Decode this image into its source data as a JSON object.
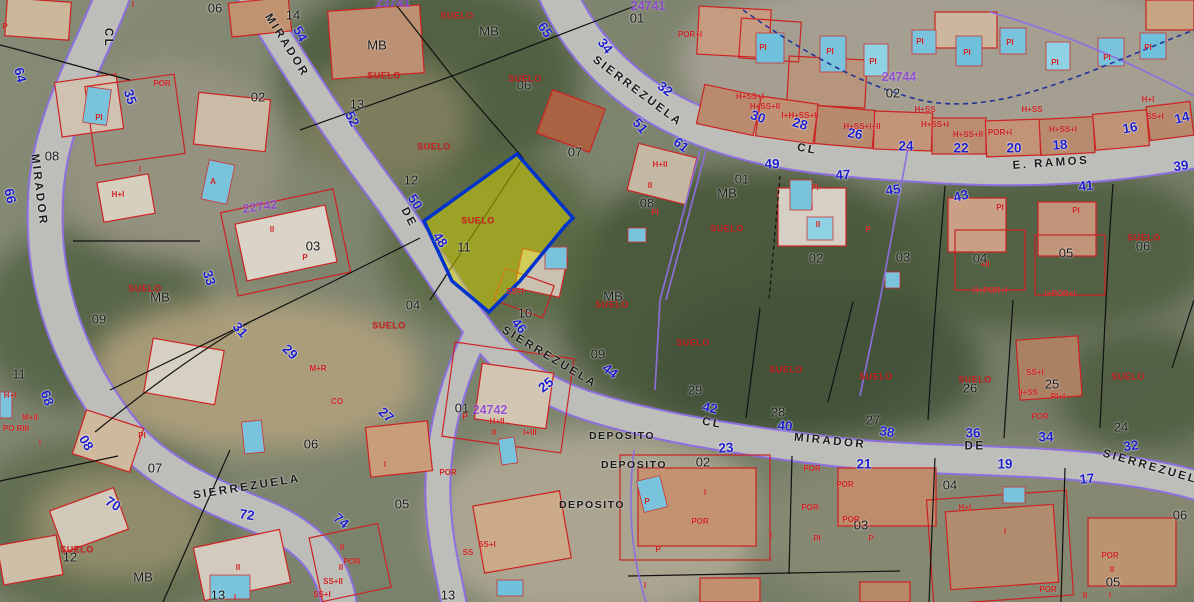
{
  "map": {
    "type": "cadastral-aerial",
    "selected_parcel": {
      "label": "SUELO",
      "fill": "#d8d800",
      "border": "#0033cc"
    },
    "colors": {
      "street_name": "#1a1a1a",
      "parcel_number": "#141414",
      "street_number": "#1c1cc8",
      "building_outline": "#cc2222",
      "suelo": "#cc2222",
      "parcel_id": "#8d3fd8",
      "urban_boundary": "#8d6fe0",
      "boundary_dashed": "#223399",
      "road_fill": "#bdbdba",
      "pool": "#79c4dc",
      "highlight_fill": "#d8d800",
      "highlight_border": "#0033cc"
    },
    "street_labels": [
      {
        "t": "CL",
        "x": 107,
        "y": 38,
        "r": 90
      },
      {
        "t": "MIRADOR",
        "x": 286,
        "y": 46,
        "r": 58
      },
      {
        "t": "MIRADOR",
        "x": 38,
        "y": 190,
        "r": 83
      },
      {
        "t": "SIERREZUELA",
        "x": 637,
        "y": 92,
        "r": 37
      },
      {
        "t": "CL",
        "x": 807,
        "y": 150,
        "r": 10
      },
      {
        "t": "E. RAMOS",
        "x": 1051,
        "y": 164,
        "r": -4
      },
      {
        "t": "DE",
        "x": 408,
        "y": 218,
        "r": 62
      },
      {
        "t": "SIERREZUELA",
        "x": 549,
        "y": 358,
        "r": 31
      },
      {
        "t": "CL",
        "x": 712,
        "y": 424,
        "r": 10
      },
      {
        "t": "MIRADOR",
        "x": 830,
        "y": 442,
        "r": 6
      },
      {
        "t": "DE",
        "x": 975,
        "y": 447,
        "r": 0
      },
      {
        "t": "SIERREZUELA",
        "x": 1155,
        "y": 469,
        "r": 16
      },
      {
        "t": "SIERREZUELA",
        "x": 247,
        "y": 488,
        "r": -9
      }
    ],
    "deposito_labels": [
      {
        "t": "DEPOSITO",
        "x": 622,
        "y": 436
      },
      {
        "t": "DEPOSITO",
        "x": 634,
        "y": 465
      },
      {
        "t": "DEPOSITO",
        "x": 592,
        "y": 505
      }
    ],
    "parcel_numbers": [
      {
        "t": "06",
        "x": 215,
        "y": 8
      },
      {
        "t": "14",
        "x": 293,
        "y": 15
      },
      {
        "t": "02",
        "x": 258,
        "y": 97
      },
      {
        "t": "08",
        "x": 52,
        "y": 156
      },
      {
        "t": "13",
        "x": 357,
        "y": 104
      },
      {
        "t": "MB",
        "x": 377,
        "y": 45
      },
      {
        "t": "MB",
        "x": 489,
        "y": 31
      },
      {
        "t": "12",
        "x": 411,
        "y": 180
      },
      {
        "t": "11",
        "x": 464,
        "y": 247
      },
      {
        "t": "06",
        "x": 524,
        "y": 85
      },
      {
        "t": "07",
        "x": 575,
        "y": 152
      },
      {
        "t": "01",
        "x": 637,
        "y": 18
      },
      {
        "t": "MB",
        "x": 160,
        "y": 297
      },
      {
        "t": "03",
        "x": 313,
        "y": 246
      },
      {
        "t": "09",
        "x": 99,
        "y": 319
      },
      {
        "t": "11",
        "x": 19,
        "y": 374
      },
      {
        "t": "01",
        "x": 742,
        "y": 179
      },
      {
        "t": "MB",
        "x": 727,
        "y": 193
      },
      {
        "t": "08",
        "x": 647,
        "y": 203
      },
      {
        "t": "02",
        "x": 816,
        "y": 258
      },
      {
        "t": "MB",
        "x": 613,
        "y": 296
      },
      {
        "t": "02",
        "x": 893,
        "y": 93
      },
      {
        "t": "03",
        "x": 903,
        "y": 257
      },
      {
        "t": "04",
        "x": 980,
        "y": 258
      },
      {
        "t": "05",
        "x": 1066,
        "y": 253
      },
      {
        "t": "06",
        "x": 1143,
        "y": 246
      },
      {
        "t": "09",
        "x": 598,
        "y": 354
      },
      {
        "t": "29",
        "x": 695,
        "y": 390
      },
      {
        "t": "28",
        "x": 778,
        "y": 412
      },
      {
        "t": "27",
        "x": 873,
        "y": 420
      },
      {
        "t": "26",
        "x": 970,
        "y": 388
      },
      {
        "t": "25",
        "x": 1052,
        "y": 384
      },
      {
        "t": "24",
        "x": 1121,
        "y": 427
      },
      {
        "t": "04",
        "x": 413,
        "y": 305
      },
      {
        "t": "10",
        "x": 525,
        "y": 313
      },
      {
        "t": "01",
        "x": 462,
        "y": 408
      },
      {
        "t": "06",
        "x": 311,
        "y": 444
      },
      {
        "t": "05",
        "x": 402,
        "y": 504
      },
      {
        "t": "13",
        "x": 448,
        "y": 595
      },
      {
        "t": "12",
        "x": 70,
        "y": 557
      },
      {
        "t": "MB",
        "x": 143,
        "y": 577
      },
      {
        "t": "13",
        "x": 218,
        "y": 595
      },
      {
        "t": "07",
        "x": 155,
        "y": 468
      },
      {
        "t": "02",
        "x": 703,
        "y": 462
      },
      {
        "t": "03",
        "x": 861,
        "y": 525
      },
      {
        "t": "04",
        "x": 950,
        "y": 485
      },
      {
        "t": "06",
        "x": 1180,
        "y": 515
      },
      {
        "t": "05",
        "x": 1113,
        "y": 582
      }
    ],
    "street_numbers": [
      {
        "t": "64",
        "x": 20,
        "y": 75,
        "r": 75
      },
      {
        "t": "66",
        "x": 10,
        "y": 196,
        "r": 78
      },
      {
        "t": "68",
        "x": 47,
        "y": 398,
        "r": 70
      },
      {
        "t": "70",
        "x": 113,
        "y": 504,
        "r": 32
      },
      {
        "t": "72",
        "x": 247,
        "y": 515,
        "r": 8
      },
      {
        "t": "74",
        "x": 341,
        "y": 521,
        "r": 40
      },
      {
        "t": "35",
        "x": 130,
        "y": 97,
        "r": 72
      },
      {
        "t": "33",
        "x": 209,
        "y": 278,
        "r": 72
      },
      {
        "t": "31",
        "x": 240,
        "y": 330,
        "r": 48
      },
      {
        "t": "29",
        "x": 290,
        "y": 352,
        "r": 45
      },
      {
        "t": "27",
        "x": 386,
        "y": 415,
        "r": 42
      },
      {
        "t": "08",
        "x": 86,
        "y": 443,
        "r": 60
      },
      {
        "t": "54",
        "x": 300,
        "y": 34,
        "r": 62
      },
      {
        "t": "52",
        "x": 352,
        "y": 119,
        "r": 62
      },
      {
        "t": "50",
        "x": 415,
        "y": 202,
        "r": 58
      },
      {
        "t": "48",
        "x": 440,
        "y": 240,
        "r": 55
      },
      {
        "t": "46",
        "x": 519,
        "y": 326,
        "r": 50
      },
      {
        "t": "25",
        "x": 546,
        "y": 385,
        "r": -38
      },
      {
        "t": "44",
        "x": 610,
        "y": 371,
        "r": 38
      },
      {
        "t": "42",
        "x": 710,
        "y": 408,
        "r": 12
      },
      {
        "t": "40",
        "x": 785,
        "y": 426,
        "r": 6
      },
      {
        "t": "38",
        "x": 887,
        "y": 432,
        "r": 8
      },
      {
        "t": "36",
        "x": 973,
        "y": 433,
        "r": 0
      },
      {
        "t": "34",
        "x": 1046,
        "y": 437,
        "r": 0
      },
      {
        "t": "32",
        "x": 1131,
        "y": 446,
        "r": -8
      },
      {
        "t": "65",
        "x": 545,
        "y": 30,
        "r": 55
      },
      {
        "t": "34",
        "x": 605,
        "y": 46,
        "r": 52
      },
      {
        "t": "32",
        "x": 665,
        "y": 89,
        "r": 38
      },
      {
        "t": "30",
        "x": 758,
        "y": 117,
        "r": 20
      },
      {
        "t": "28",
        "x": 800,
        "y": 124,
        "r": 16
      },
      {
        "t": "26",
        "x": 855,
        "y": 134,
        "r": 10
      },
      {
        "t": "51",
        "x": 640,
        "y": 126,
        "r": 50
      },
      {
        "t": "61",
        "x": 681,
        "y": 145,
        "r": 38
      },
      {
        "t": "24",
        "x": 906,
        "y": 146,
        "r": 0
      },
      {
        "t": "22",
        "x": 961,
        "y": 148,
        "r": 0
      },
      {
        "t": "20",
        "x": 1014,
        "y": 148,
        "r": 0
      },
      {
        "t": "18",
        "x": 1060,
        "y": 145,
        "r": -4
      },
      {
        "t": "16",
        "x": 1130,
        "y": 128,
        "r": -10
      },
      {
        "t": "14",
        "x": 1182,
        "y": 118,
        "r": -14
      },
      {
        "t": "49",
        "x": 772,
        "y": 164,
        "r": 0
      },
      {
        "t": "47",
        "x": 843,
        "y": 175,
        "r": -4
      },
      {
        "t": "45",
        "x": 893,
        "y": 190,
        "r": -8
      },
      {
        "t": "43",
        "x": 961,
        "y": 196,
        "r": -14
      },
      {
        "t": "41",
        "x": 1086,
        "y": 186,
        "r": -6
      },
      {
        "t": "39",
        "x": 1181,
        "y": 166,
        "r": -8
      },
      {
        "t": "23",
        "x": 726,
        "y": 448,
        "r": -4
      },
      {
        "t": "21",
        "x": 864,
        "y": 464,
        "r": 0
      },
      {
        "t": "19",
        "x": 1005,
        "y": 464,
        "r": 0
      },
      {
        "t": "17",
        "x": 1087,
        "y": 479,
        "r": -6
      }
    ],
    "parcel_ids": [
      {
        "t": "22742",
        "x": 260,
        "y": 207,
        "r": -8
      },
      {
        "t": "24744",
        "x": 899,
        "y": 77,
        "r": 0
      },
      {
        "t": "24742",
        "x": 490,
        "y": 410,
        "r": 0
      },
      {
        "t": "23741",
        "x": 393,
        "y": 3,
        "r": 0
      },
      {
        "t": "24741",
        "x": 648,
        "y": 6,
        "r": 0
      }
    ],
    "suelo_labels": [
      {
        "x": 457,
        "y": 16
      },
      {
        "x": 384,
        "y": 76
      },
      {
        "x": 525,
        "y": 79
      },
      {
        "x": 434,
        "y": 147
      },
      {
        "x": 145,
        "y": 289
      },
      {
        "x": 478,
        "y": 221
      },
      {
        "x": 727,
        "y": 229
      },
      {
        "x": 389,
        "y": 326
      },
      {
        "x": 612,
        "y": 305
      },
      {
        "x": 693,
        "y": 343
      },
      {
        "x": 786,
        "y": 370
      },
      {
        "x": 876,
        "y": 377
      },
      {
        "x": 1144,
        "y": 238
      },
      {
        "x": 975,
        "y": 380
      },
      {
        "x": 1128,
        "y": 377
      },
      {
        "x": 77,
        "y": 550
      }
    ],
    "building_annotations": [
      {
        "t": "P",
        "x": 5,
        "y": 27
      },
      {
        "t": "I",
        "x": 133,
        "y": 5
      },
      {
        "t": "POR",
        "x": 162,
        "y": 84
      },
      {
        "t": "PI",
        "x": 99,
        "y": 118
      },
      {
        "t": "I",
        "x": 140,
        "y": 170
      },
      {
        "t": "A",
        "x": 213,
        "y": 182
      },
      {
        "t": "H+I",
        "x": 118,
        "y": 195
      },
      {
        "t": "II",
        "x": 272,
        "y": 230
      },
      {
        "t": "P",
        "x": 305,
        "y": 258
      },
      {
        "t": "PI",
        "x": 142,
        "y": 436
      },
      {
        "t": "PO RIII",
        "x": 16,
        "y": 429
      },
      {
        "t": "M+II",
        "x": 30,
        "y": 418
      },
      {
        "t": "H+I",
        "x": 10,
        "y": 396
      },
      {
        "t": "I",
        "x": 40,
        "y": 443
      },
      {
        "t": "POR+I",
        "x": 690,
        "y": 35
      },
      {
        "t": "H+SS+I",
        "x": 750,
        "y": 97
      },
      {
        "t": "H+SS+II",
        "x": 765,
        "y": 107
      },
      {
        "t": "I+H+SS+II",
        "x": 800,
        "y": 116
      },
      {
        "t": "H+SS+I+II",
        "x": 862,
        "y": 127
      },
      {
        "t": "PI",
        "x": 763,
        "y": 48
      },
      {
        "t": "PI",
        "x": 830,
        "y": 52
      },
      {
        "t": "PI",
        "x": 873,
        "y": 62
      },
      {
        "t": "PI",
        "x": 920,
        "y": 42
      },
      {
        "t": "PI",
        "x": 967,
        "y": 53
      },
      {
        "t": "PI",
        "x": 1010,
        "y": 43
      },
      {
        "t": "PI",
        "x": 1055,
        "y": 63
      },
      {
        "t": "PI",
        "x": 1107,
        "y": 58
      },
      {
        "t": "PI",
        "x": 1148,
        "y": 48
      },
      {
        "t": "H+SS",
        "x": 925,
        "y": 110
      },
      {
        "t": "H+SS+I",
        "x": 935,
        "y": 125
      },
      {
        "t": "H+SS+II",
        "x": 968,
        "y": 135
      },
      {
        "t": "POR+I",
        "x": 1000,
        "y": 133
      },
      {
        "t": "H+SS",
        "x": 1032,
        "y": 110
      },
      {
        "t": "H+SS+I",
        "x": 1063,
        "y": 130
      },
      {
        "t": "H+I",
        "x": 1148,
        "y": 100
      },
      {
        "t": "SS+I",
        "x": 1155,
        "y": 117
      },
      {
        "t": "H+II",
        "x": 660,
        "y": 165
      },
      {
        "t": "II",
        "x": 650,
        "y": 186
      },
      {
        "t": "PI",
        "x": 655,
        "y": 213
      },
      {
        "t": "PI",
        "x": 815,
        "y": 188
      },
      {
        "t": "I",
        "x": 812,
        "y": 208
      },
      {
        "t": "II",
        "x": 818,
        "y": 225
      },
      {
        "t": "P",
        "x": 868,
        "y": 230
      },
      {
        "t": "PI",
        "x": 1000,
        "y": 208
      },
      {
        "t": "PI",
        "x": 1076,
        "y": 211
      },
      {
        "t": "H+POR+I",
        "x": 990,
        "y": 291
      },
      {
        "t": "+II",
        "x": 985,
        "y": 265
      },
      {
        "t": "I+POR+I",
        "x": 1060,
        "y": 294
      },
      {
        "t": "SS+I",
        "x": 1035,
        "y": 373
      },
      {
        "t": "II+SS",
        "x": 1028,
        "y": 393
      },
      {
        "t": "PI+I",
        "x": 1058,
        "y": 397
      },
      {
        "t": "POR",
        "x": 1040,
        "y": 417
      },
      {
        "t": "M+R",
        "x": 318,
        "y": 369
      },
      {
        "t": "CO",
        "x": 337,
        "y": 402
      },
      {
        "t": "P",
        "x": 465,
        "y": 417
      },
      {
        "t": "H+II",
        "x": 497,
        "y": 422
      },
      {
        "t": "II",
        "x": 494,
        "y": 433
      },
      {
        "t": "I+III",
        "x": 530,
        "y": 433
      },
      {
        "t": "SS+I",
        "x": 515,
        "y": 292
      },
      {
        "t": "POR",
        "x": 448,
        "y": 473
      },
      {
        "t": "I",
        "x": 385,
        "y": 465
      },
      {
        "t": "II",
        "x": 342,
        "y": 548
      },
      {
        "t": "POR",
        "x": 352,
        "y": 562
      },
      {
        "t": "II",
        "x": 341,
        "y": 568
      },
      {
        "t": "SS+II",
        "x": 333,
        "y": 582
      },
      {
        "t": "SS+I",
        "x": 322,
        "y": 595
      },
      {
        "t": "SS",
        "x": 468,
        "y": 553
      },
      {
        "t": "SS+I",
        "x": 487,
        "y": 545
      },
      {
        "t": "II",
        "x": 238,
        "y": 568
      },
      {
        "t": "I",
        "x": 235,
        "y": 598
      },
      {
        "t": "I",
        "x": 705,
        "y": 493
      },
      {
        "t": "POR",
        "x": 700,
        "y": 522
      },
      {
        "t": "I",
        "x": 771,
        "y": 536
      },
      {
        "t": "I",
        "x": 645,
        "y": 586
      },
      {
        "t": "P",
        "x": 647,
        "y": 502
      },
      {
        "t": "P",
        "x": 658,
        "y": 550
      },
      {
        "t": "POR",
        "x": 812,
        "y": 469
      },
      {
        "t": "POR",
        "x": 845,
        "y": 485
      },
      {
        "t": "POR",
        "x": 810,
        "y": 508
      },
      {
        "t": "POR",
        "x": 851,
        "y": 520
      },
      {
        "t": "PI",
        "x": 817,
        "y": 539
      },
      {
        "t": "P",
        "x": 871,
        "y": 539
      },
      {
        "t": "H+I",
        "x": 965,
        "y": 508
      },
      {
        "t": "I",
        "x": 1005,
        "y": 532
      },
      {
        "t": "POR",
        "x": 1110,
        "y": 556
      },
      {
        "t": "II",
        "x": 1112,
        "y": 570
      },
      {
        "t": "POR",
        "x": 1048,
        "y": 590
      },
      {
        "t": "II",
        "x": 1085,
        "y": 596
      },
      {
        "t": "I",
        "x": 1110,
        "y": 596
      }
    ]
  }
}
